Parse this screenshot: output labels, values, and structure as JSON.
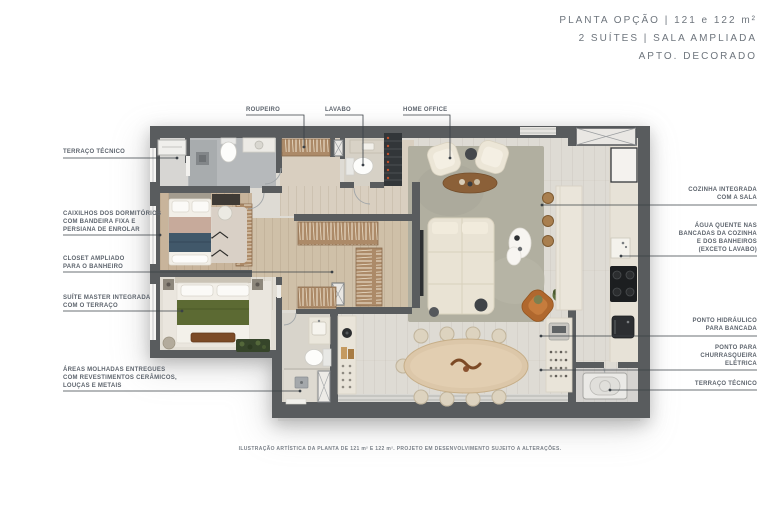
{
  "title": {
    "line1": "PLANTA OPÇÃO | 121 e 122 m²",
    "line2": "2 SUÍTES | SALA AMPLIADA",
    "line3": "APTO. DECORADO"
  },
  "annotations": {
    "top": [
      {
        "id": "roupeiro",
        "text": "ROUPEIRO"
      },
      {
        "id": "lavabo",
        "text": "LAVABO"
      },
      {
        "id": "home-office",
        "text": "HOME OFFICE"
      }
    ],
    "left": [
      {
        "id": "terraco-tecnico-1",
        "lines": [
          "TERRAÇO TÉCNICO"
        ]
      },
      {
        "id": "caixilhos",
        "lines": [
          "CAIXILHOS DOS DORMITÓRIOS",
          "COM BANDEIRA FIXA E",
          "PERSIANA DE ENROLAR"
        ]
      },
      {
        "id": "closet",
        "lines": [
          "CLOSET AMPLIADO",
          "PARA O BANHEIRO"
        ]
      },
      {
        "id": "suite-master",
        "lines": [
          "SUÍTE MASTER INTEGRADA",
          "COM O TERRAÇO"
        ]
      },
      {
        "id": "areas-molhadas",
        "lines": [
          "ÁREAS MOLHADAS ENTREGUES",
          "COM REVESTIMENTOS CERÂMICOS,",
          "LOUÇAS E METAIS"
        ]
      }
    ],
    "right": [
      {
        "id": "cozinha-integrada",
        "lines": [
          "COZINHA INTEGRADA",
          "COM A SALA"
        ]
      },
      {
        "id": "agua-quente",
        "lines": [
          "ÁGUA QUENTE NAS",
          "BANCADAS DA COZINHA",
          "E DOS BANHEIROS",
          "(EXCETO LAVABO)"
        ]
      },
      {
        "id": "ponto-hidraulico",
        "lines": [
          "PONTO HIDRÁULICO",
          "PARA BANCADA"
        ]
      },
      {
        "id": "churrasqueira",
        "lines": [
          "PONTO PARA",
          "CHURRASQUEIRA",
          "ELÉTRICA"
        ]
      },
      {
        "id": "terraco-tecnico-2",
        "lines": [
          "TERRAÇO TÉCNICO"
        ]
      }
    ]
  },
  "footer": {
    "caption": "ILUSTRAÇÃO ARTÍSTICA DA PLANTA DE 121 m² E 122 m². PROJETO EM DESENVOLVIMENTO SUJEITO A ALTERAÇÕES."
  },
  "colors": {
    "wall": "#595c5e",
    "floor_tile": "#dedbd4",
    "floor_wood": "#d2c3ac",
    "rug_living": "#b1afa0",
    "label_text": "#5d646d",
    "title_text": "#6e757d",
    "leader_line": "#3a4046",
    "accent_orange_chair": "#b0682e",
    "accent_green_bed": "#5c6a33",
    "accent_teal_bed": "#41586a"
  }
}
